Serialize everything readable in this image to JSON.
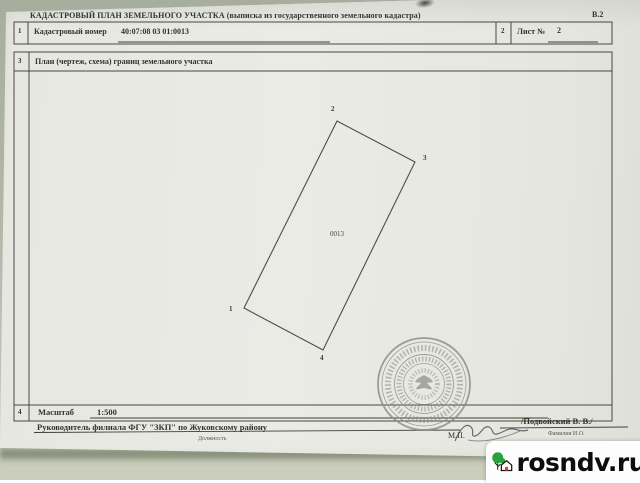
{
  "photo": {
    "background_color": "#b0b6a6",
    "paper_color": "#e8e8e3"
  },
  "document": {
    "form_code": "В.2",
    "title": "КАДАСТРОВЫЙ ПЛАН ЗЕМЕЛЬНОГО УЧАСТКА (выписка из государственного земельного кадастра)",
    "rows": {
      "r1": {
        "num": "1",
        "label": "Кадастровый номер",
        "value": "40:07:08 03 01:0013"
      },
      "r2": {
        "num": "2",
        "label": "Лист №",
        "value": "2"
      },
      "r3": {
        "num": "3",
        "label": "План (чертеж, схема) границ земельного участка"
      },
      "r4": {
        "num": "4",
        "label": "Масштаб",
        "value": "1:500"
      }
    },
    "plan": {
      "parcel_label": "0013",
      "vertices": [
        {
          "n": "1",
          "px": 244,
          "py": 308,
          "lx": 229,
          "ly": 306
        },
        {
          "n": "2",
          "px": 337,
          "py": 121,
          "lx": 331,
          "ly": 106
        },
        {
          "n": "3",
          "px": 415,
          "py": 162,
          "lx": 423,
          "ly": 155
        },
        {
          "n": "4",
          "px": 323,
          "py": 350,
          "lx": 320,
          "ly": 355
        }
      ]
    },
    "footer": {
      "head_line": "Руководитель филиала ФГУ \"ЗКП\" по Жуковскому району",
      "head_caption": "Должность",
      "stamp_abbr": "М.П.",
      "signer_name": "/Подвойский В. В./",
      "signer_caption": "Фамилия И.О."
    }
  },
  "watermark": {
    "text": "rosndv.ru",
    "tree_color": "#27a23c",
    "door_color": "#e2402f",
    "text_color": "#0d0d0d"
  }
}
